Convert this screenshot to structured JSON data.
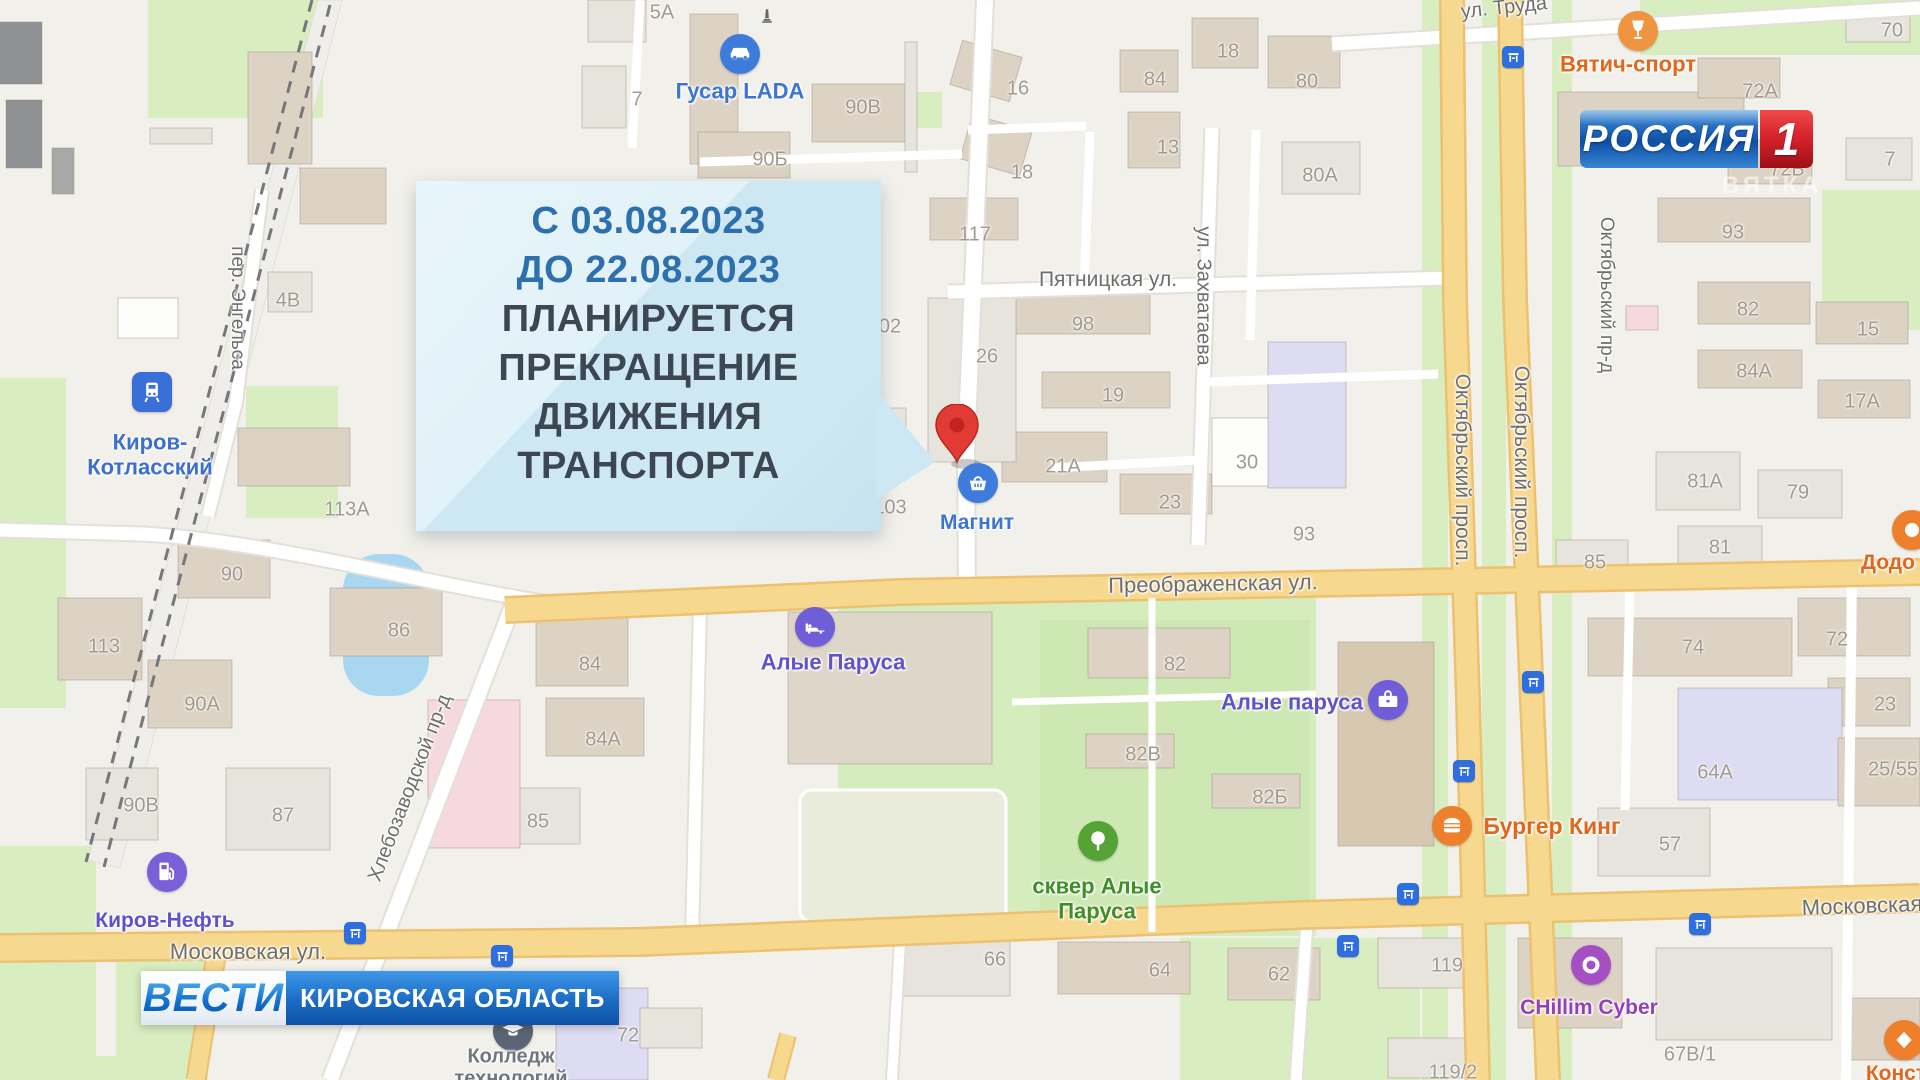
{
  "broadcast": {
    "channel": "РОССИЯ",
    "channel_number": "1",
    "watermark": "ВЯТКА",
    "banner_program": "ВЕСТИ",
    "banner_region": "КИРОВСКАЯ ОБЛАСТЬ"
  },
  "callout": {
    "date_line1": "С 03.08.2023",
    "date_line2": "ДО 22.08.2023",
    "line3": "ПЛАНИРУЕТСЯ",
    "line4": "ПРЕКРАЩЕНИЕ",
    "line5": "ДВИЖЕНИЯ",
    "line6": "ТРАНСПОРТА",
    "date_color": "#2e6fad",
    "text_color": "#3d4653",
    "bg_color": "#cfe9f3"
  },
  "map": {
    "pin": {
      "x": 957,
      "y": 462,
      "color": "#e23b35"
    },
    "street_labels": [
      {
        "text": "Пятницкая ул.",
        "x": 1108,
        "y": 280,
        "rot": 0,
        "size": 21
      },
      {
        "text": "ул. Захватаева",
        "x": 1203,
        "y": 296,
        "rot": 90,
        "size": 20
      },
      {
        "text": "Октябрьский просп.",
        "x": 1462,
        "y": 470,
        "rot": 90,
        "size": 21
      },
      {
        "text": "Октябрьский просп.",
        "x": 1521,
        "y": 462,
        "rot": 90,
        "size": 21
      },
      {
        "text": "Октябрьский пр-д",
        "x": 1606,
        "y": 295,
        "rot": 90,
        "size": 19
      },
      {
        "text": "пер. Энгельса",
        "x": 237,
        "y": 308,
        "rot": 90,
        "size": 19
      },
      {
        "text": "Хлебозаводской пр-д",
        "x": 410,
        "y": 788,
        "rot": -69,
        "size": 20
      },
      {
        "text": "Преображенская ул.",
        "x": 1213,
        "y": 584,
        "rot": -1,
        "size": 22
      },
      {
        "text": "Московская ул.",
        "x": 248,
        "y": 952,
        "rot": 0,
        "size": 22
      },
      {
        "text": "Московская",
        "x": 1862,
        "y": 906,
        "rot": -2,
        "size": 22
      },
      {
        "text": "ул. Труда",
        "x": 1504,
        "y": 8,
        "rot": -6,
        "size": 20
      }
    ],
    "building_numbers": [
      {
        "text": "5А",
        "x": 662,
        "y": 13
      },
      {
        "text": "7",
        "x": 637,
        "y": 100
      },
      {
        "text": "90В",
        "x": 863,
        "y": 108
      },
      {
        "text": "90Б",
        "x": 770,
        "y": 160
      },
      {
        "text": "16",
        "x": 1018,
        "y": 89
      },
      {
        "text": "18",
        "x": 1022,
        "y": 173
      },
      {
        "text": "84",
        "x": 1155,
        "y": 80
      },
      {
        "text": "13",
        "x": 1168,
        "y": 148
      },
      {
        "text": "18",
        "x": 1228,
        "y": 52
      },
      {
        "text": "80",
        "x": 1307,
        "y": 82
      },
      {
        "text": "80А",
        "x": 1320,
        "y": 176
      },
      {
        "text": "117",
        "x": 975,
        "y": 235
      },
      {
        "text": "98",
        "x": 1083,
        "y": 325
      },
      {
        "text": "26",
        "x": 987,
        "y": 357
      },
      {
        "text": "19",
        "x": 1113,
        "y": 396
      },
      {
        "text": "02",
        "x": 890,
        "y": 327
      },
      {
        "text": "21А",
        "x": 1063,
        "y": 467
      },
      {
        "text": "23",
        "x": 1170,
        "y": 503
      },
      {
        "text": "30",
        "x": 1247,
        "y": 463
      },
      {
        "text": "93",
        "x": 1304,
        "y": 535
      },
      {
        "text": "103",
        "x": 890,
        "y": 508
      },
      {
        "text": "70",
        "x": 1892,
        "y": 31
      },
      {
        "text": "72А",
        "x": 1760,
        "y": 92
      },
      {
        "text": "72Б",
        "x": 1787,
        "y": 170
      },
      {
        "text": "7",
        "x": 1890,
        "y": 160
      },
      {
        "text": "93",
        "x": 1733,
        "y": 233
      },
      {
        "text": "82",
        "x": 1748,
        "y": 310
      },
      {
        "text": "15",
        "x": 1868,
        "y": 330
      },
      {
        "text": "84А",
        "x": 1754,
        "y": 372
      },
      {
        "text": "17А",
        "x": 1862,
        "y": 402
      },
      {
        "text": "81А",
        "x": 1705,
        "y": 482
      },
      {
        "text": "79",
        "x": 1798,
        "y": 493
      },
      {
        "text": "81",
        "x": 1720,
        "y": 548
      },
      {
        "text": "85",
        "x": 1595,
        "y": 563
      },
      {
        "text": "4В",
        "x": 288,
        "y": 301
      },
      {
        "text": "113А",
        "x": 347,
        "y": 510
      },
      {
        "text": "113",
        "x": 104,
        "y": 647
      },
      {
        "text": "90",
        "x": 232,
        "y": 575
      },
      {
        "text": "86",
        "x": 399,
        "y": 631
      },
      {
        "text": "90А",
        "x": 202,
        "y": 705
      },
      {
        "text": "84",
        "x": 590,
        "y": 665
      },
      {
        "text": "84А",
        "x": 603,
        "y": 740
      },
      {
        "text": "87",
        "x": 283,
        "y": 816
      },
      {
        "text": "90В",
        "x": 141,
        "y": 806
      },
      {
        "text": "85",
        "x": 538,
        "y": 822
      },
      {
        "text": "82",
        "x": 1175,
        "y": 665
      },
      {
        "text": "82В",
        "x": 1143,
        "y": 755
      },
      {
        "text": "82Б",
        "x": 1270,
        "y": 798
      },
      {
        "text": "74",
        "x": 1693,
        "y": 648
      },
      {
        "text": "72",
        "x": 1837,
        "y": 640
      },
      {
        "text": "23",
        "x": 1885,
        "y": 705
      },
      {
        "text": "25/55",
        "x": 1893,
        "y": 770
      },
      {
        "text": "64А",
        "x": 1715,
        "y": 773
      },
      {
        "text": "57",
        "x": 1670,
        "y": 845
      },
      {
        "text": "66",
        "x": 995,
        "y": 960
      },
      {
        "text": "64",
        "x": 1160,
        "y": 971
      },
      {
        "text": "62",
        "x": 1279,
        "y": 975
      },
      {
        "text": "72",
        "x": 628,
        "y": 1036
      },
      {
        "text": "119",
        "x": 1447,
        "y": 966
      },
      {
        "text": "119/2",
        "x": 1453,
        "y": 1073
      },
      {
        "text": "67В/1",
        "x": 1690,
        "y": 1055
      }
    ],
    "pois": [
      {
        "id": "gusar-lada",
        "label": "Гусар LADA",
        "icon": "car",
        "shape": "circle",
        "x": 740,
        "y": 54,
        "color": "#3d7cdb",
        "lx": 740,
        "ly": 92,
        "label_color": "#3c74d4",
        "lsize": 22
      },
      {
        "id": "railway-station",
        "label": "Киров-\nКотласский",
        "icon": "train",
        "shape": "square",
        "x": 152,
        "y": 392,
        "color": "#3a6fd8",
        "lx": 150,
        "ly": 455,
        "label_color": "#3d6fcf",
        "lsize": 22
      },
      {
        "id": "magnit",
        "label": "Магнит",
        "icon": "basket",
        "shape": "circle",
        "x": 978,
        "y": 483,
        "color": "#3d7cdb",
        "lx": 977,
        "ly": 523,
        "label_color": "#3c74d4",
        "lsize": 21
      },
      {
        "id": "alye-parusa-hotel",
        "label": "Алые Паруса",
        "icon": "bed",
        "shape": "circle",
        "x": 815,
        "y": 627,
        "color": "#6f5ed8",
        "lx": 833,
        "ly": 663,
        "label_color": "#6052cc",
        "lsize": 22
      },
      {
        "id": "alye-parusa-mall",
        "label": "Алые паруса",
        "icon": "bag",
        "shape": "circle",
        "x": 1388,
        "y": 700,
        "color": "#6f5ed8",
        "lx": 1292,
        "ly": 703,
        "label_color": "#6052cc",
        "lsize": 22
      },
      {
        "id": "burger-king",
        "label": "Бургер Кинг",
        "icon": "burger",
        "shape": "circle",
        "x": 1452,
        "y": 826,
        "color": "#ee7f2d",
        "lx": 1552,
        "ly": 827,
        "label_color": "#e2661b",
        "lsize": 23
      },
      {
        "id": "vyatich-sport",
        "label": "Вятич-спорт",
        "icon": "goblet",
        "shape": "circle",
        "x": 1638,
        "y": 31,
        "color": "#ef9440",
        "lx": 1628,
        "ly": 65,
        "label_color": "#e2661b",
        "lsize": 22
      },
      {
        "id": "kirov-neft",
        "label": "Киров-Нефть",
        "icon": "fuel",
        "shape": "circle",
        "x": 167,
        "y": 872,
        "color": "#7a5fd8",
        "lx": 165,
        "ly": 921,
        "label_color": "#6052cc",
        "lsize": 21
      },
      {
        "id": "skver-alye-parusa",
        "label": "сквер Алые\nПаруса",
        "icon": "tree",
        "shape": "circle",
        "x": 1098,
        "y": 841,
        "color": "#55a335",
        "lx": 1097,
        "ly": 899,
        "label_color": "#3f8f28",
        "lsize": 22
      },
      {
        "id": "chillim-cyber",
        "label": "CHillim Cyber",
        "icon": "ring",
        "shape": "circle",
        "x": 1591,
        "y": 965,
        "color": "#a64ec4",
        "lx": 1589,
        "ly": 1008,
        "label_color": "#9440b8",
        "lsize": 21
      },
      {
        "id": "dodo",
        "label": "Додо",
        "icon": "blob",
        "shape": "circle",
        "x": 1912,
        "y": 530,
        "color": "#ee7f2d",
        "lx": 1888,
        "ly": 563,
        "label_color": "#e2661b",
        "lsize": 21
      },
      {
        "id": "college",
        "label": "Колледж\nтехнологий",
        "icon": "grad",
        "shape": "circle",
        "x": 513,
        "y": 1031,
        "color": "#5b6474",
        "lx": 511,
        "ly": 1068,
        "label_color": "#707681",
        "lsize": 20
      },
      {
        "id": "konst",
        "label": "Конст",
        "icon": "diamond",
        "shape": "circle",
        "x": 1904,
        "y": 1040,
        "color": "#ee7f2d",
        "lx": 1896,
        "ly": 1074,
        "label_color": "#e2661b",
        "lsize": 21
      },
      {
        "id": "monument",
        "label": "",
        "icon": "obelisk",
        "shape": "plain",
        "x": 767,
        "y": 16,
        "color": "#63666d",
        "lx": 0,
        "ly": 0,
        "label_color": "#63666d",
        "lsize": 18
      }
    ],
    "transit_stops": [
      [
        1513,
        57
      ],
      [
        1533,
        682
      ],
      [
        1464,
        771
      ],
      [
        1408,
        894
      ],
      [
        1348,
        946
      ],
      [
        1700,
        924
      ],
      [
        502,
        956
      ],
      [
        355,
        933
      ]
    ]
  }
}
